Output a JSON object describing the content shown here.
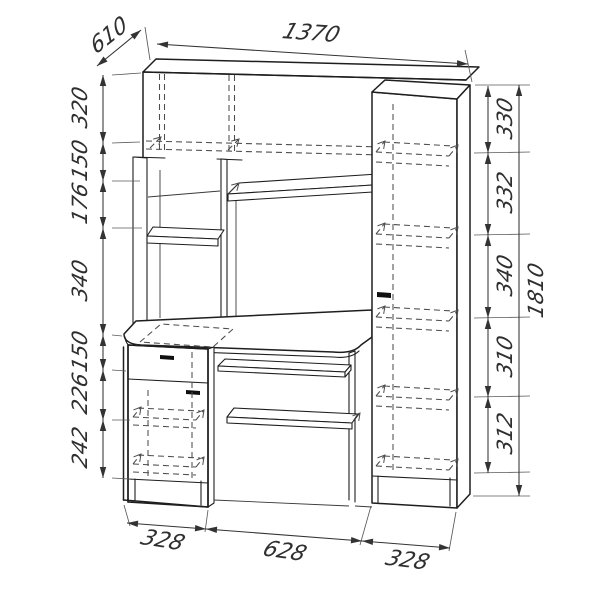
{
  "drawing": {
    "title": "computer-desk-dimension-drawing",
    "dims": {
      "top_width": "1370",
      "depth": "610",
      "overall_height": "1810",
      "left_chain": [
        "320",
        "150",
        "176",
        "340",
        "150",
        "226",
        "242"
      ],
      "right_chain": [
        "330",
        "332",
        "340",
        "310",
        "312"
      ],
      "bottom_chain": [
        "328",
        "628",
        "328"
      ]
    },
    "colors": {
      "line": "#1e1e1e",
      "hidden_line": "#4d4d4d",
      "dimension": "#333333",
      "background": "#ffffff"
    }
  }
}
